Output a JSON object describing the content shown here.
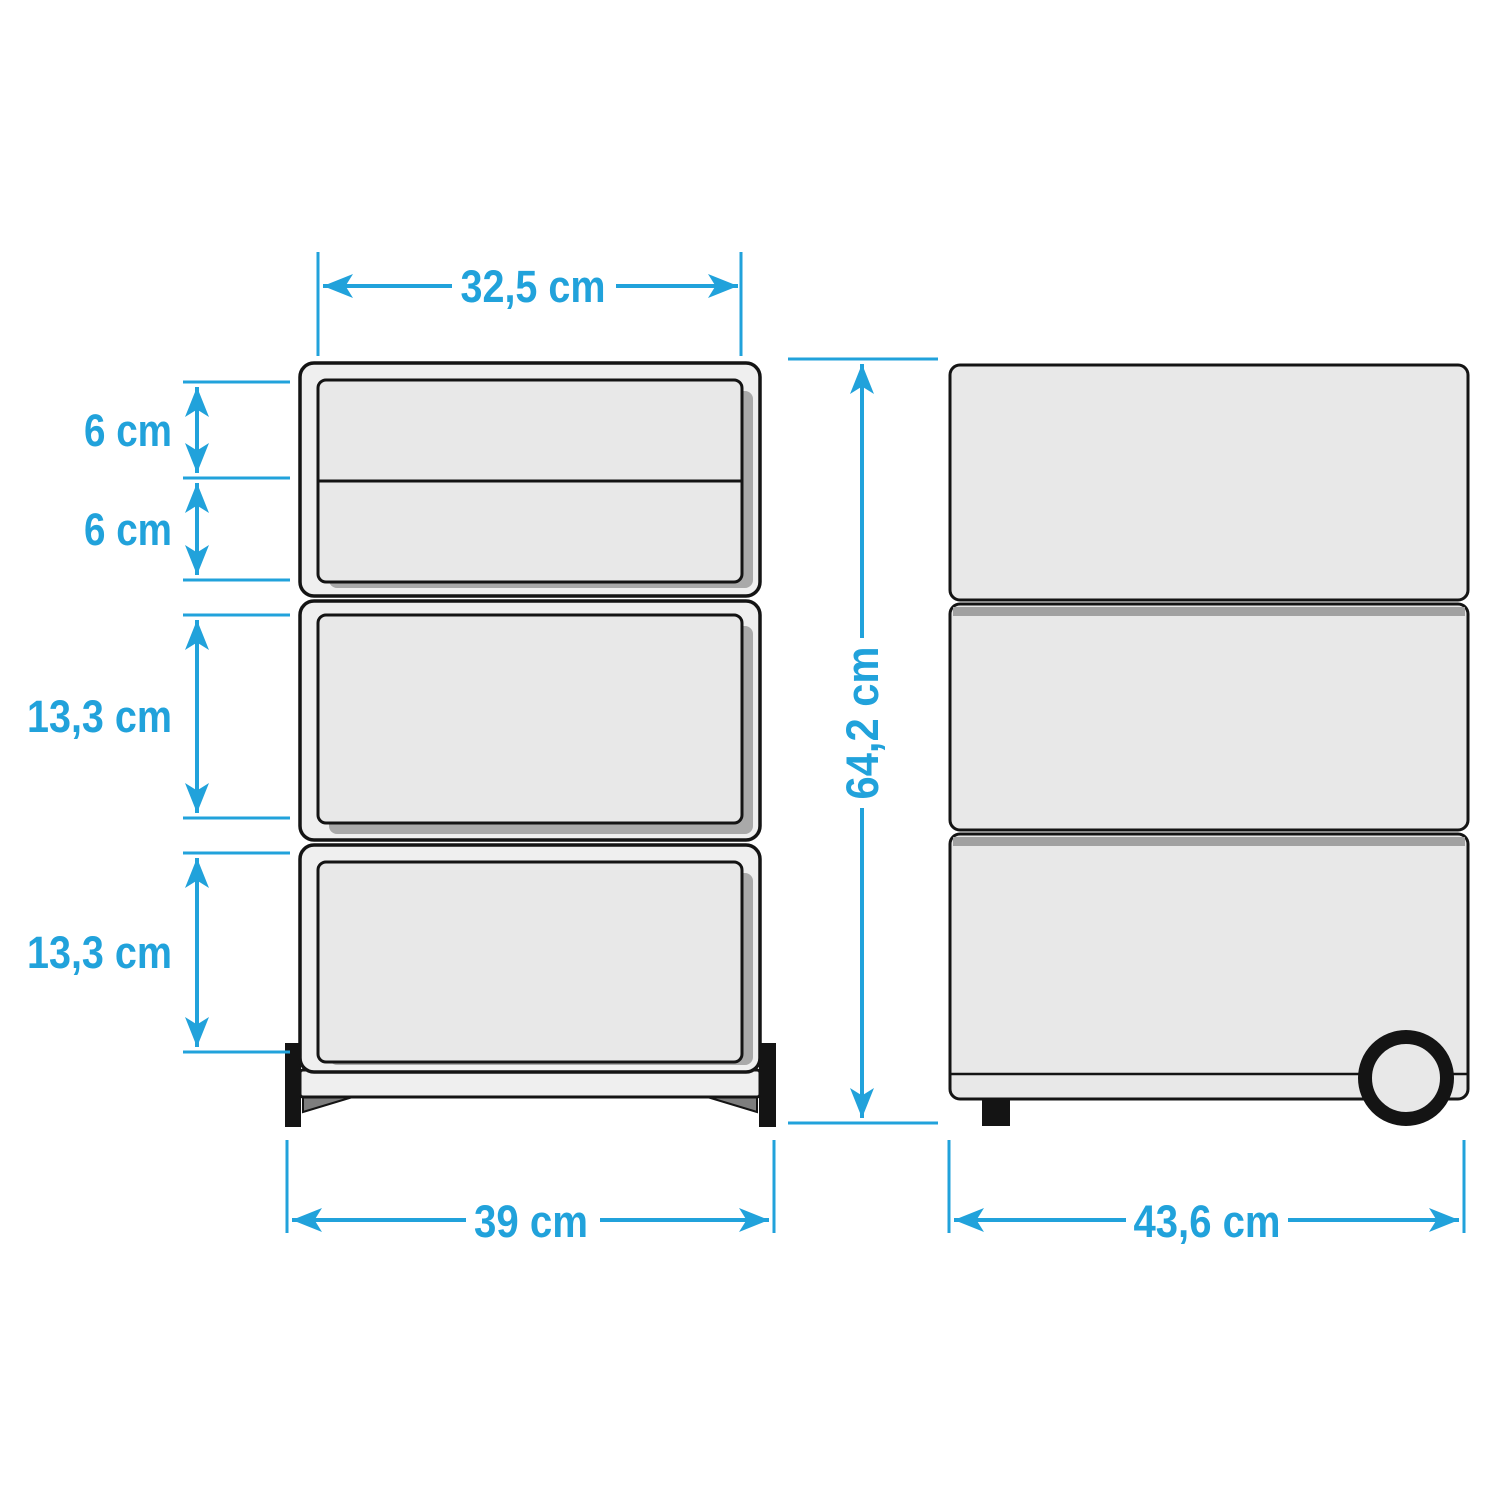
{
  "diagram": {
    "unit": "cm",
    "dimensions": {
      "top_width": "32,5 cm",
      "drawer_1_height": "6 cm",
      "drawer_2_height": "6 cm",
      "drawer_3_height": "13,3 cm",
      "drawer_4_height": "13,3 cm",
      "base_width": "39 cm",
      "total_height": "64,2 cm",
      "depth": "43,6 cm"
    }
  },
  "colors": {
    "accent": "#21A2DB",
    "outline": "#141414",
    "body": "#EFEFEF",
    "drawer": "#E8E8E8",
    "shadow": "#A9A9A9",
    "band": "#A1A1A1",
    "plinth": "#7E7E7E",
    "bg": "#FFFFFF"
  }
}
